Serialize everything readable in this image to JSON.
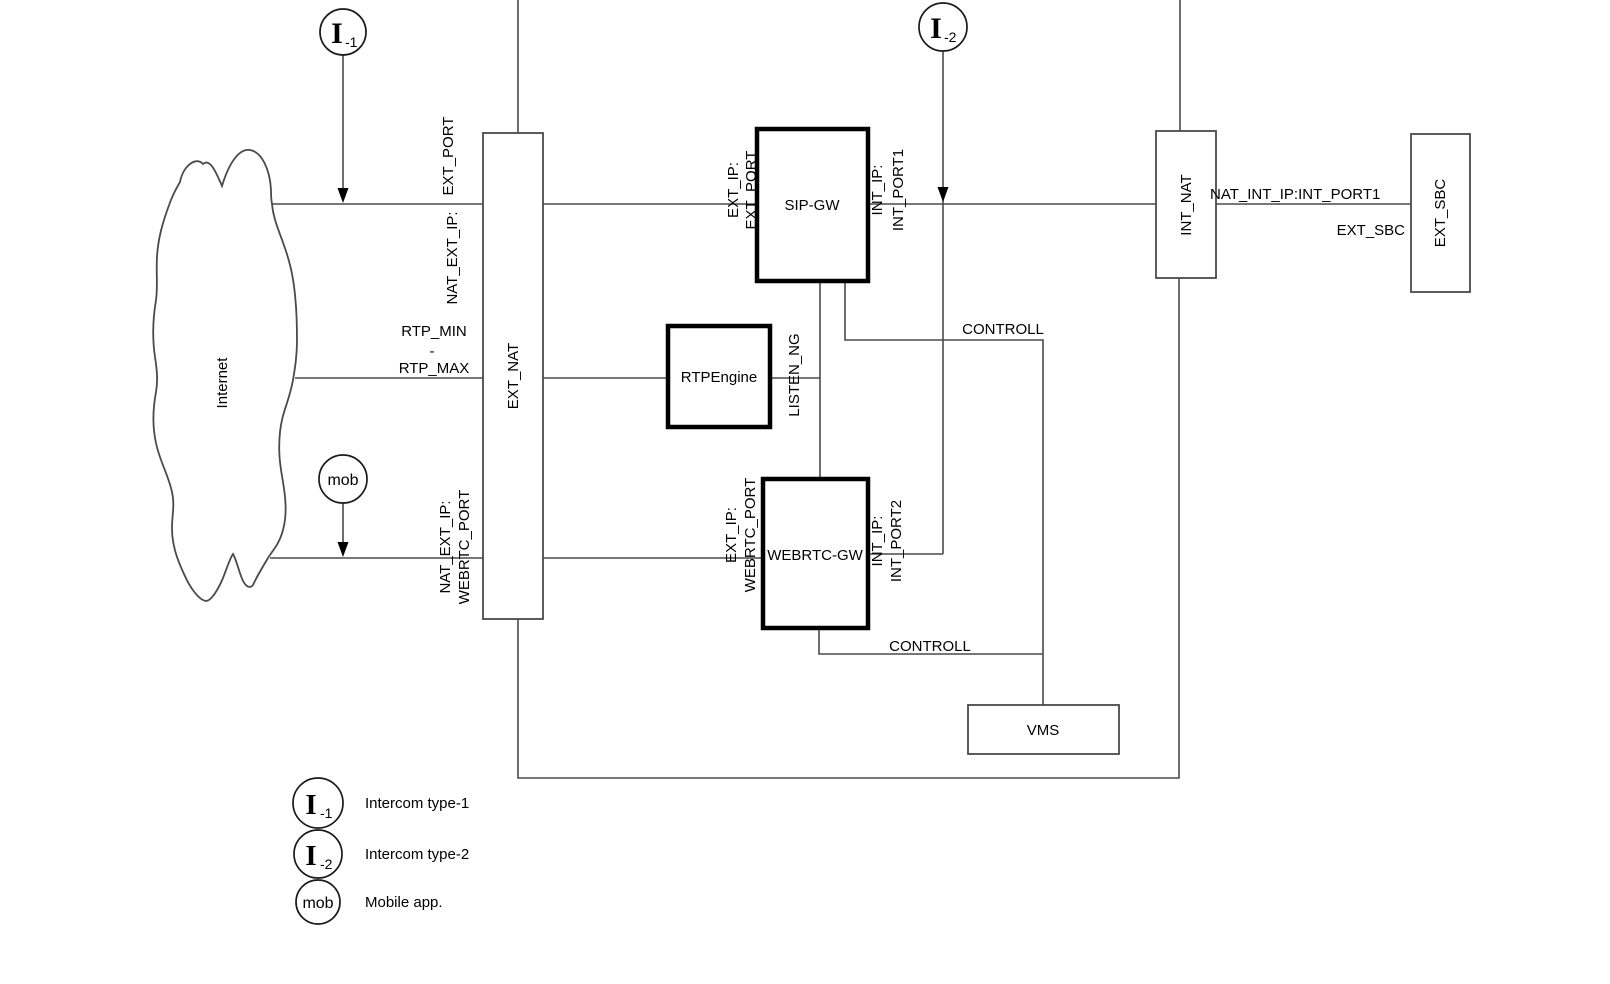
{
  "diagram": {
    "colors": {
      "background": "#ffffff",
      "line": "#4a4a4a",
      "thick_border": "#000000",
      "text": "#000000"
    },
    "nodes": {
      "internet": "Internet",
      "ext_nat": "EXT_NAT",
      "sip_gw": "SIP-GW",
      "rtpengine": "RTPEngine",
      "webrtc_gw": "WEBRTC-GW",
      "int_nat": "INT_NAT",
      "ext_sbc": "EXT_SBC",
      "vms": "VMS"
    },
    "actors": {
      "intercom1": {
        "glyph": "I",
        "subscript": "-1"
      },
      "intercom2": {
        "glyph": "I",
        "subscript": "-2"
      },
      "mobile": {
        "glyph": "mob"
      }
    },
    "labels": {
      "ext_port": "EXT_PORT",
      "nat_ext_ip": "NAT_EXT_IP:",
      "rtp_min": "RTP_MIN",
      "rtp_dash": "-",
      "rtp_max": "RTP_MAX",
      "nat_ext_ip_webrtc_l1": "NAT_EXT_IP:",
      "nat_ext_ip_webrtc_l2": "WEBRTC_PORT",
      "sip_ext_ip": "EXT_IP:",
      "sip_ext_port": "EXT_PORT",
      "sip_int_ip": "INT_IP:",
      "sip_int_port": "INT_PORT1",
      "listen_ng": "LISTEN_NG",
      "webrtc_ext_ip": "EXT_IP:",
      "webrtc_ext_port": "WEBRTC_PORT",
      "webrtc_int_ip": "INT_IP:",
      "webrtc_int_port": "INT_PORT2",
      "controll_sip": "CONTROLL",
      "controll_webrtc": "CONTROLL",
      "nat_int_ip_port": "NAT_INT_IP:INT_PORT1",
      "ext_sbc_conn": "EXT_SBC"
    },
    "legend": [
      {
        "glyph": "I",
        "subscript": "-1",
        "label": "Intercom type-1"
      },
      {
        "glyph": "I",
        "subscript": "-2",
        "label": "Intercom type-2"
      },
      {
        "glyph": "mob",
        "subscript": "",
        "label": "Mobile app."
      }
    ]
  }
}
